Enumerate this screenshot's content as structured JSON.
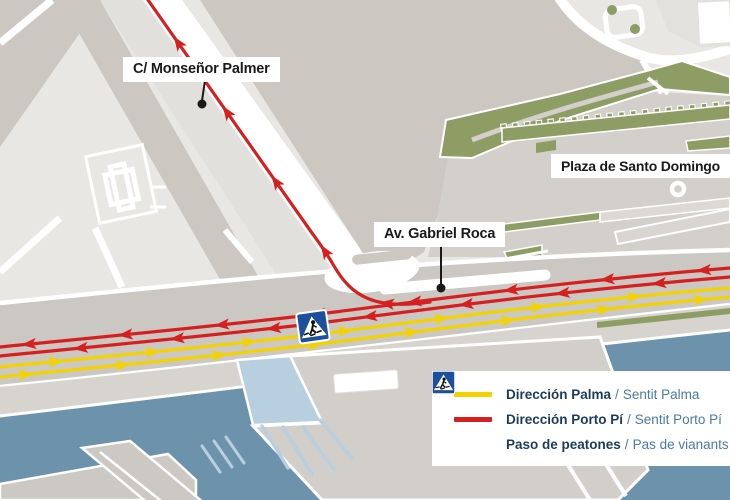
{
  "map": {
    "street_labels": [
      {
        "text": "C/ Monseñor Palmer"
      },
      {
        "text": "Plaza de Santo Domingo"
      },
      {
        "text": "Av. Gabriel Roca"
      }
    ]
  },
  "legend": {
    "separator": "/",
    "items": [
      {
        "swatch": "yellow-line",
        "primary": "Dirección Palma",
        "secondary": "Sentit Palma"
      },
      {
        "swatch": "red-line",
        "primary": "Dirección Porto Pí",
        "secondary": "Sentit Porto Pí"
      },
      {
        "swatch": "crosswalk-sign",
        "primary": "Paso de peatones",
        "secondary": "Pas de vianants"
      }
    ]
  },
  "colors": {
    "direccion_palma_yellow": "#f2d200",
    "direccion_porto_pi_red": "#d6201f",
    "water_blue": "#6d92ac",
    "marina_light_blue": "#b8cfe0",
    "park_green": "#8e9d64",
    "building_gray": "#ccc7c1",
    "road_white": "#ffffff",
    "legend_primary_navy": "#1d3c5a",
    "legend_secondary_blue": "#4b7ba3",
    "crosswalk_sign_blue": "#1c4f9c",
    "callout_black": "#1a1a1a"
  }
}
